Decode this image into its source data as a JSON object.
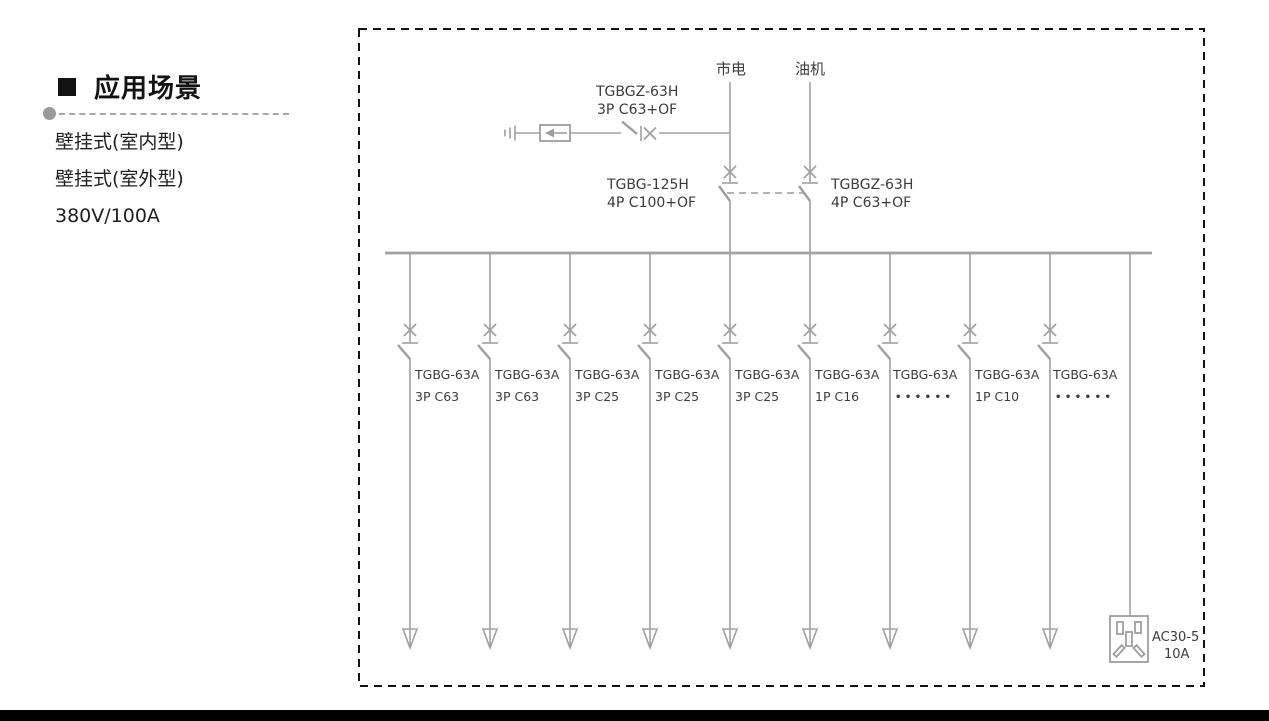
{
  "page": {
    "background": "#ffffff",
    "bottom_bar_color": "#000000",
    "diagram_line_color": "#a2a2a2",
    "diagram_text_color": "#3c3c3c",
    "border_style": "black dashed rectangle"
  },
  "sidebar": {
    "title": "应用场景",
    "items": [
      "壁挂式(室内型)",
      "壁挂式(室外型)",
      "380V/100A"
    ]
  },
  "diagram": {
    "sources": [
      {
        "label": "市电"
      },
      {
        "label": "油机"
      }
    ],
    "spd_breaker": {
      "model": "TGBGZ-63H",
      "rating": "3P C63+OF"
    },
    "main_breakers": [
      {
        "model": "TGBG-125H",
        "rating": "4P C100+OF"
      },
      {
        "model": "TGBGZ-63H",
        "rating": "4P C63+OF"
      }
    ],
    "branches": [
      {
        "model": "TGBG-63A",
        "rating": "3P C63"
      },
      {
        "model": "TGBG-63A",
        "rating": "3P C63"
      },
      {
        "model": "TGBG-63A",
        "rating": "3P C25"
      },
      {
        "model": "TGBG-63A",
        "rating": "3P C25"
      },
      {
        "model": "TGBG-63A",
        "rating": "3P C25"
      },
      {
        "model": "TGBG-63A",
        "rating": "1P C16"
      },
      {
        "model": "TGBG-63A",
        "rating": "••••••"
      },
      {
        "model": "TGBG-63A",
        "rating": "1P C10"
      },
      {
        "model": "TGBG-63A",
        "rating": "••••••"
      }
    ],
    "socket": {
      "model": "AC30-5",
      "rating": "10A"
    }
  }
}
